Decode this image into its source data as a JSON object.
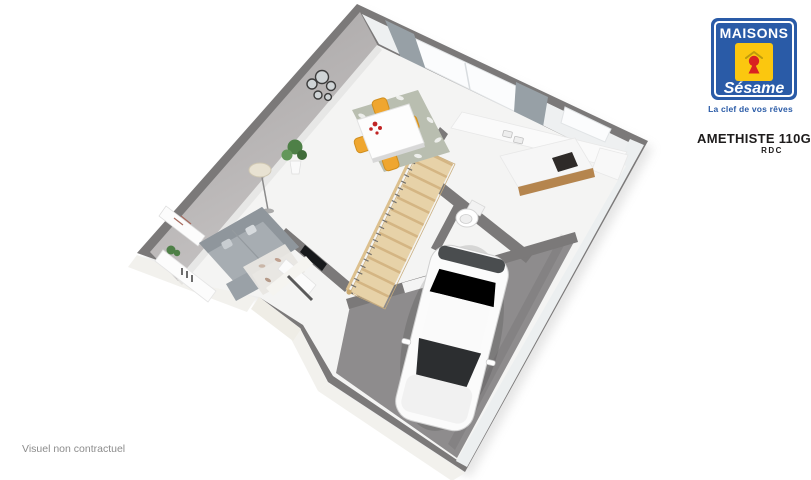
{
  "branding": {
    "logo_line1": "MAISONS",
    "logo_line2": "Sésame",
    "tagline": "La clef de vos rêves",
    "model_name": "AMETHISTE 110GI",
    "floor_label": "RDC"
  },
  "footer": {
    "disclaimer": "Visuel non contractuel"
  },
  "palette": {
    "wall": "#7b7979",
    "wall_face": "#b4b1b1",
    "floor": "#f4f4f3",
    "garage_floor": "#8e8c8d",
    "stair_wood": "#e7d2a8",
    "stair_wood_dark": "#d4b583",
    "chair": "#efa62f",
    "sofa": "#a7adb2",
    "rug": "#b9beb0",
    "curtain": "#97a0a6",
    "car_body": "#fbfbfb",
    "car_glass": "#2c2e30",
    "plant": "#4e8047",
    "logo_blue": "#2a5ba7",
    "logo_yellow": "#fbc70f",
    "logo_red": "#d92121",
    "text_dark": "#1d1b1b",
    "text_gray": "#8c8c8c"
  }
}
